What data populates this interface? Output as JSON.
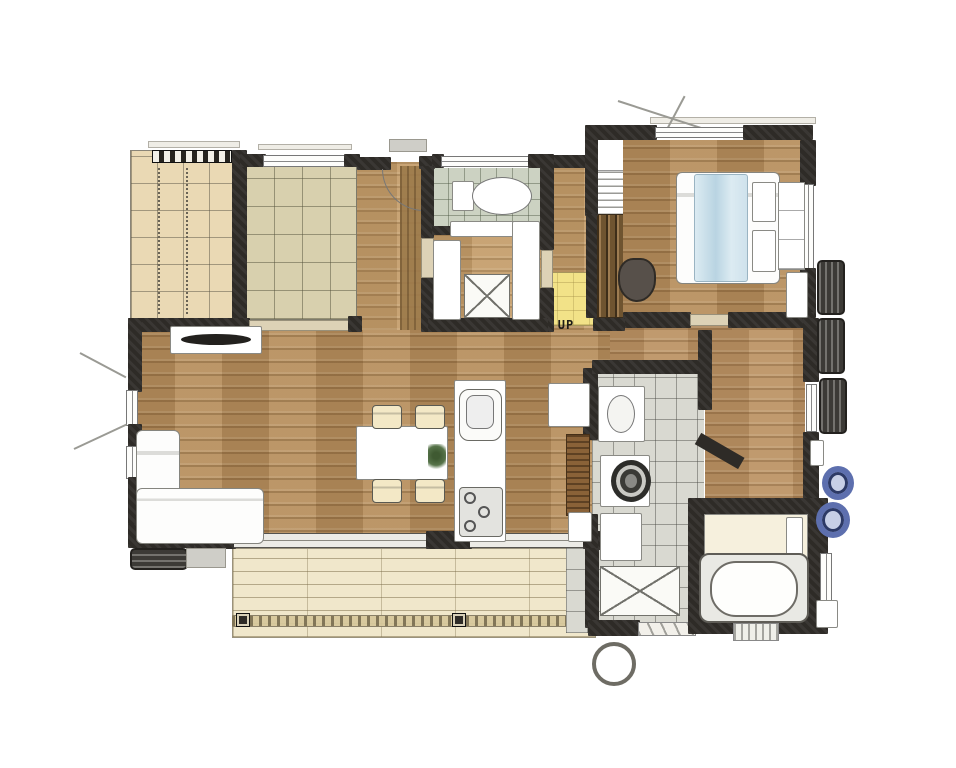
{
  "title": "hand-drawn house floor plan",
  "labels": {
    "stairs_up": "UP"
  },
  "palette": {
    "wall": "#2e2b27",
    "wood": "#b68f5e",
    "wood_light": "#c49e6c",
    "tatami": "#d8d0ae",
    "grid_beige": "#ead9b4",
    "tile_green": "#ccd2c2",
    "tile_gray": "#d9d9d1",
    "deck": "#f0e7cb",
    "landing": "#f2e288",
    "door_wood": "#8a6238",
    "accent_blue": "#5d6fae",
    "duvet_blue": "#cfe2ec"
  },
  "shapes": [
    {
      "n": "engawa-floor",
      "c": "grid-beige",
      "x": 130,
      "y": 150,
      "w": 106,
      "h": 170
    },
    {
      "n": "engawa-dot-strip",
      "c": "dot-strip",
      "x": 158,
      "y": 168,
      "w": 2,
      "h": 146
    },
    {
      "n": "engawa-dot-strip",
      "c": "dot-strip",
      "x": 186,
      "y": 168,
      "w": 2,
      "h": 146
    },
    {
      "n": "tatami-room-floor",
      "c": "tatami",
      "x": 245,
      "y": 162,
      "w": 112,
      "h": 158
    },
    {
      "n": "entrance-hall-floor",
      "c": "wood-light",
      "x": 357,
      "y": 162,
      "w": 70,
      "h": 170
    },
    {
      "n": "entrance-tataki-strip",
      "c": "wood-strip",
      "x": 400,
      "y": 166,
      "w": 26,
      "h": 164
    },
    {
      "n": "toilet-floor",
      "c": "tile-green",
      "x": 432,
      "y": 168,
      "w": 110,
      "h": 64
    },
    {
      "n": "storage-room-floor",
      "c": "wood-light",
      "x": 432,
      "y": 232,
      "w": 110,
      "h": 88
    },
    {
      "n": "hall-floor",
      "c": "wood-light",
      "x": 544,
      "y": 158,
      "w": 56,
      "h": 172
    },
    {
      "n": "stair-landing",
      "c": "landing",
      "x": 540,
      "y": 272,
      "w": 58,
      "h": 54
    },
    {
      "n": "stairwell",
      "c": "white-box",
      "x": 597,
      "y": 136,
      "w": 27,
      "h": 80
    },
    {
      "n": "stair-treads",
      "c": "treads",
      "x": 597,
      "y": 170,
      "w": 27,
      "h": 46
    },
    {
      "n": "stair-slats",
      "c": "slats",
      "x": 596,
      "y": 214,
      "w": 28,
      "h": 104
    },
    {
      "n": "bedroom-floor",
      "c": "wood",
      "x": 623,
      "y": 140,
      "w": 180,
      "h": 178
    },
    {
      "n": "corridor-floor",
      "c": "wood-mid",
      "x": 600,
      "y": 318,
      "w": 208,
      "h": 60
    },
    {
      "n": "corridor-floor",
      "c": "wood-mid",
      "x": 705,
      "y": 330,
      "w": 100,
      "h": 180
    },
    {
      "n": "ldk-floor",
      "c": "wood",
      "x": 128,
      "y": 330,
      "w": 482,
      "h": 215
    },
    {
      "n": "washroom-floor",
      "c": "tile-gray",
      "x": 592,
      "y": 372,
      "w": 112,
      "h": 258
    },
    {
      "n": "wood-deck",
      "c": "deck",
      "x": 232,
      "y": 548,
      "w": 364,
      "h": 90
    },
    {
      "n": "deck-runner",
      "c": "deck-runner",
      "x": 232,
      "y": 615,
      "w": 364,
      "h": 12
    },
    {
      "n": "deck-post",
      "c": "post-dark",
      "x": 236,
      "y": 613,
      "w": 14,
      "h": 14
    },
    {
      "n": "deck-post",
      "c": "post-dark",
      "x": 452,
      "y": 613,
      "w": 14,
      "h": 14
    },
    {
      "n": "outside-tile-patch",
      "c": "tile-gray",
      "x": 566,
      "y": 533,
      "w": 40,
      "h": 100
    },
    {
      "n": "eave-line",
      "c": "eave",
      "x": 148,
      "y": 141,
      "w": 92,
      "h": 7
    },
    {
      "n": "eave-line",
      "c": "eave",
      "x": 258,
      "y": 144,
      "w": 94,
      "h": 6
    },
    {
      "n": "eave-line",
      "c": "eave",
      "x": 650,
      "y": 117,
      "w": 166,
      "h": 7
    },
    {
      "n": "entrance-porch-step",
      "c": "porch",
      "x": 389,
      "y": 139,
      "w": 38,
      "h": 13
    },
    {
      "n": "canopy-line",
      "c": "line-diag",
      "x": 618,
      "y": 100,
      "w": 92,
      "h": 2,
      "r": 18
    },
    {
      "n": "canopy-line",
      "c": "line-diag",
      "x": 664,
      "y": 134,
      "w": 44,
      "h": 2,
      "r": -62
    },
    {
      "n": "closet-shelf-band",
      "c": "shelf-band",
      "x": 152,
      "y": 150,
      "w": 80,
      "h": 13
    },
    {
      "n": "wall",
      "c": "wall",
      "x": 232,
      "y": 150,
      "w": 15,
      "h": 170
    },
    {
      "n": "wall",
      "c": "wall",
      "x": 240,
      "y": 154,
      "w": 26,
      "h": 13
    },
    {
      "n": "tatami-window",
      "c": "window-h",
      "x": 263,
      "y": 155,
      "w": 84,
      "h": 12
    },
    {
      "n": "wall",
      "c": "wall",
      "x": 344,
      "y": 154,
      "w": 16,
      "h": 13
    },
    {
      "n": "wall",
      "c": "wall",
      "x": 357,
      "y": 157,
      "w": 34,
      "h": 13
    },
    {
      "n": "wall",
      "c": "wall",
      "x": 419,
      "y": 156,
      "w": 16,
      "h": 13
    },
    {
      "n": "wall",
      "c": "wall",
      "x": 432,
      "y": 154,
      "w": 12,
      "h": 14
    },
    {
      "n": "toilet-window",
      "c": "window-h",
      "x": 441,
      "y": 156,
      "w": 90,
      "h": 11
    },
    {
      "n": "wall",
      "c": "wall",
      "x": 528,
      "y": 154,
      "w": 16,
      "h": 14
    },
    {
      "n": "wall",
      "c": "wall",
      "x": 541,
      "y": 155,
      "w": 46,
      "h": 13
    },
    {
      "n": "entrance-door-arc",
      "c": "arc",
      "x": 382,
      "y": 169,
      "w": 42,
      "h": 42
    },
    {
      "n": "entrance-door-leaf",
      "c": "line-v",
      "x": 421,
      "y": 169,
      "w": 2,
      "h": 42
    },
    {
      "n": "wall",
      "c": "wall",
      "x": 421,
      "y": 166,
      "w": 13,
      "h": 72
    },
    {
      "n": "storage-door",
      "c": "door-light",
      "x": 421,
      "y": 238,
      "w": 13,
      "h": 40
    },
    {
      "n": "wall",
      "c": "wall",
      "x": 421,
      "y": 278,
      "w": 13,
      "h": 54
    },
    {
      "n": "wall",
      "c": "wall",
      "x": 432,
      "y": 226,
      "w": 80,
      "h": 9
    },
    {
      "n": "wall",
      "c": "wall",
      "x": 540,
      "y": 154,
      "w": 14,
      "h": 96
    },
    {
      "n": "toilet-door",
      "c": "door-light",
      "x": 541,
      "y": 250,
      "w": 12,
      "h": 38
    },
    {
      "n": "wall",
      "c": "wall",
      "x": 540,
      "y": 288,
      "w": 14,
      "h": 44
    },
    {
      "n": "wall",
      "c": "wall",
      "x": 585,
      "y": 128,
      "w": 13,
      "h": 88
    },
    {
      "n": "wall",
      "c": "wall",
      "x": 586,
      "y": 214,
      "w": 11,
      "h": 104
    },
    {
      "n": "wall",
      "c": "wall",
      "x": 585,
      "y": 125,
      "w": 72,
      "h": 15
    },
    {
      "n": "bedroom-window-north",
      "c": "window-h",
      "x": 655,
      "y": 127,
      "w": 90,
      "h": 11
    },
    {
      "n": "wall",
      "c": "wall",
      "x": 743,
      "y": 125,
      "w": 70,
      "h": 15
    },
    {
      "n": "wall",
      "c": "wall",
      "x": 800,
      "y": 140,
      "w": 16,
      "h": 46
    },
    {
      "n": "bedroom-window-east",
      "c": "window-v",
      "x": 803,
      "y": 184,
      "w": 11,
      "h": 86
    },
    {
      "n": "wall",
      "c": "wall",
      "x": 800,
      "y": 268,
      "w": 16,
      "h": 50
    },
    {
      "n": "wall",
      "c": "wall",
      "x": 623,
      "y": 312,
      "w": 68,
      "h": 16
    },
    {
      "n": "bedroom-door",
      "c": "door-light",
      "x": 690,
      "y": 314,
      "w": 40,
      "h": 12
    },
    {
      "n": "wall",
      "c": "wall",
      "x": 728,
      "y": 312,
      "w": 86,
      "h": 16
    },
    {
      "n": "wall",
      "c": "wall",
      "x": 128,
      "y": 318,
      "w": 122,
      "h": 14
    },
    {
      "n": "tatami-sliding-door",
      "c": "door-light",
      "x": 249,
      "y": 320,
      "w": 100,
      "h": 11
    },
    {
      "n": "wall",
      "c": "wall",
      "x": 348,
      "y": 316,
      "w": 14,
      "h": 16
    },
    {
      "n": "wall",
      "c": "wall",
      "x": 428,
      "y": 318,
      "w": 120,
      "h": 14
    },
    {
      "n": "wall",
      "c": "wall",
      "x": 593,
      "y": 318,
      "w": 32,
      "h": 13
    },
    {
      "n": "wall",
      "c": "wall",
      "x": 128,
      "y": 318,
      "w": 14,
      "h": 74
    },
    {
      "n": "living-window-west",
      "c": "window-v",
      "x": 126,
      "y": 390,
      "w": 12,
      "h": 36
    },
    {
      "n": "wall",
      "c": "wall",
      "x": 128,
      "y": 424,
      "w": 14,
      "h": 23
    },
    {
      "n": "living-window-west",
      "c": "window-v",
      "x": 126,
      "y": 446,
      "w": 12,
      "h": 33
    },
    {
      "n": "wall",
      "c": "wall",
      "x": 128,
      "y": 477,
      "w": 14,
      "h": 60
    },
    {
      "n": "window-vent-line",
      "c": "line-diag",
      "x": 80,
      "y": 352,
      "w": 52,
      "h": 2,
      "r": 28
    },
    {
      "n": "window-vent-line",
      "c": "line-diag",
      "x": 74,
      "y": 448,
      "w": 58,
      "h": 2,
      "r": -25
    },
    {
      "n": "wall",
      "c": "wall",
      "x": 128,
      "y": 524,
      "w": 70,
      "h": 24
    },
    {
      "n": "wall",
      "c": "wall",
      "x": 194,
      "y": 530,
      "w": 42,
      "h": 19
    },
    {
      "n": "deck-sliding-door",
      "c": "door-glass",
      "x": 234,
      "y": 533,
      "w": 194,
      "h": 15
    },
    {
      "n": "wall",
      "c": "wall",
      "x": 426,
      "y": 531,
      "w": 46,
      "h": 18
    },
    {
      "n": "deck-sliding-door",
      "c": "door-glass",
      "x": 470,
      "y": 533,
      "w": 120,
      "h": 15
    },
    {
      "n": "wall",
      "c": "wall",
      "x": 588,
      "y": 531,
      "w": 24,
      "h": 19
    },
    {
      "n": "wall",
      "c": "wall",
      "x": 583,
      "y": 368,
      "w": 15,
      "h": 72
    },
    {
      "n": "washroom-pocket-door",
      "c": "door-wood",
      "x": 566,
      "y": 434,
      "w": 24,
      "h": 82
    },
    {
      "n": "wall",
      "c": "wall",
      "x": 583,
      "y": 514,
      "w": 15,
      "h": 35
    },
    {
      "n": "wall",
      "c": "wall",
      "x": 585,
      "y": 548,
      "w": 14,
      "h": 80
    },
    {
      "n": "wall",
      "c": "wall",
      "x": 588,
      "y": 620,
      "w": 52,
      "h": 16
    },
    {
      "n": "shower-door-threshold",
      "c": "door-tri",
      "x": 638,
      "y": 622,
      "w": 58,
      "h": 14
    },
    {
      "n": "hose-ring",
      "c": "ring",
      "x": 592,
      "y": 642,
      "w": 44,
      "h": 44
    },
    {
      "n": "wall",
      "c": "wall",
      "x": 592,
      "y": 360,
      "w": 118,
      "h": 14
    },
    {
      "n": "wall",
      "c": "wall",
      "x": 698,
      "y": 330,
      "w": 14,
      "h": 80
    },
    {
      "n": "wall-angled",
      "c": "wall-diag",
      "x": 698,
      "y": 432,
      "w": 50,
      "h": 13,
      "r": 30
    },
    {
      "n": "wall",
      "c": "wall",
      "x": 803,
      "y": 318,
      "w": 16,
      "h": 64
    },
    {
      "n": "corridor-window-east",
      "c": "window-v",
      "x": 806,
      "y": 384,
      "w": 11,
      "h": 48
    },
    {
      "n": "wall",
      "c": "wall",
      "x": 803,
      "y": 432,
      "w": 16,
      "h": 76
    },
    {
      "n": "bathroom-walls",
      "c": "wall",
      "x": 688,
      "y": 498,
      "w": 140,
      "h": 136
    },
    {
      "n": "bathroom-washing-area",
      "c": "cream-box",
      "x": 704,
      "y": 514,
      "w": 104,
      "h": 44
    },
    {
      "n": "bathroom-door",
      "c": "white-box",
      "x": 786,
      "y": 517,
      "w": 17,
      "h": 40
    },
    {
      "n": "bathtub-surround",
      "c": "tub-surround",
      "x": 699,
      "y": 553,
      "w": 110,
      "h": 70
    },
    {
      "n": "bathtub",
      "c": "tub",
      "x": 710,
      "y": 561,
      "w": 88,
      "h": 56
    },
    {
      "n": "bath-mat",
      "c": "mat-stripe",
      "x": 733,
      "y": 623,
      "w": 46,
      "h": 18
    },
    {
      "n": "bath-window-east",
      "c": "window-v",
      "x": 820,
      "y": 553,
      "w": 12,
      "h": 48
    },
    {
      "n": "bath-vent-unit",
      "c": "white-box",
      "x": 816,
      "y": 600,
      "w": 22,
      "h": 28
    },
    {
      "n": "ac-outdoor-unit",
      "c": "ac-unit",
      "x": 817,
      "y": 260,
      "w": 28,
      "h": 55
    },
    {
      "n": "ac-outdoor-unit",
      "c": "ac-unit",
      "x": 817,
      "y": 318,
      "w": 28,
      "h": 56
    },
    {
      "n": "ac-outdoor-unit",
      "c": "ac-unit",
      "x": 819,
      "y": 378,
      "w": 28,
      "h": 56
    },
    {
      "n": "utility-box",
      "c": "white-box",
      "x": 810,
      "y": 440,
      "w": 14,
      "h": 26
    },
    {
      "n": "hose-reel",
      "c": "reel",
      "x": 822,
      "y": 466,
      "w": 32,
      "h": 34
    },
    {
      "n": "hose-reel",
      "c": "reel",
      "x": 816,
      "y": 502,
      "w": 34,
      "h": 36
    },
    {
      "n": "outdoor-unit",
      "c": "ac-unit-h",
      "x": 130,
      "y": 548,
      "w": 58,
      "h": 22
    },
    {
      "n": "garden-step",
      "c": "porch",
      "x": 186,
      "y": 548,
      "w": 40,
      "h": 20
    },
    {
      "n": "tv-board",
      "c": "white-box",
      "x": 170,
      "y": 326,
      "w": 92,
      "h": 28
    },
    {
      "n": "tv",
      "c": "tv",
      "x": 181,
      "y": 334,
      "w": 70,
      "h": 11
    },
    {
      "n": "sofa-chaise",
      "c": "soft",
      "x": 136,
      "y": 430,
      "w": 44,
      "h": 112
    },
    {
      "n": "sofa-body",
      "c": "soft",
      "x": 136,
      "y": 488,
      "w": 128,
      "h": 56
    },
    {
      "n": "dining-table",
      "c": "white-box",
      "x": 356,
      "y": 426,
      "w": 92,
      "h": 54
    },
    {
      "n": "dining-chair",
      "c": "chair-cream",
      "x": 372,
      "y": 405,
      "w": 30,
      "h": 24
    },
    {
      "n": "dining-chair",
      "c": "chair-cream",
      "x": 415,
      "y": 405,
      "w": 30,
      "h": 24
    },
    {
      "n": "dining-chair",
      "c": "chair-cream",
      "x": 372,
      "y": 479,
      "w": 30,
      "h": 24
    },
    {
      "n": "dining-chair",
      "c": "chair-cream",
      "x": 415,
      "y": 479,
      "w": 30,
      "h": 24
    },
    {
      "n": "table-plant",
      "c": "plant",
      "x": 428,
      "y": 444,
      "w": 18,
      "h": 26
    },
    {
      "n": "kitchen-counter",
      "c": "white-box",
      "x": 454,
      "y": 380,
      "w": 52,
      "h": 162
    },
    {
      "n": "kitchen-sink-unit",
      "c": "sink-unit",
      "x": 459,
      "y": 389,
      "w": 43,
      "h": 52
    },
    {
      "n": "kitchen-sink",
      "c": "sink-inner",
      "x": 466,
      "y": 395,
      "w": 28,
      "h": 34
    },
    {
      "n": "kitchen-stove",
      "c": "stove",
      "x": 459,
      "y": 487,
      "w": 44,
      "h": 50
    },
    {
      "n": "stove-burner",
      "c": "burner",
      "x": 464,
      "y": 492,
      "w": 12,
      "h": 12
    },
    {
      "n": "stove-burner",
      "c": "burner",
      "x": 478,
      "y": 506,
      "w": 12,
      "h": 12
    },
    {
      "n": "stove-burner",
      "c": "burner",
      "x": 464,
      "y": 520,
      "w": 12,
      "h": 12
    },
    {
      "n": "toilet-tank",
      "c": "white-box",
      "x": 452,
      "y": 181,
      "w": 22,
      "h": 30
    },
    {
      "n": "toilet-bowl",
      "c": "toilet-bowl",
      "x": 472,
      "y": 177,
      "w": 60,
      "h": 38
    },
    {
      "n": "storage-cabinet",
      "c": "white-box",
      "x": 450,
      "y": 221,
      "w": 66,
      "h": 16
    },
    {
      "n": "storage-cabinet",
      "c": "white-box",
      "x": 433,
      "y": 240,
      "w": 28,
      "h": 80
    },
    {
      "n": "storage-cabinet",
      "c": "white-box",
      "x": 512,
      "y": 221,
      "w": 28,
      "h": 99
    },
    {
      "n": "storage-hatch",
      "c": "x-box",
      "x": 464,
      "y": 274,
      "w": 46,
      "h": 44
    },
    {
      "n": "bed",
      "c": "soft",
      "x": 676,
      "y": 172,
      "w": 104,
      "h": 112
    },
    {
      "n": "bed-duvet",
      "c": "duvet",
      "x": 694,
      "y": 174,
      "w": 54,
      "h": 108
    },
    {
      "n": "bed-pillow",
      "c": "white-box",
      "x": 752,
      "y": 182,
      "w": 24,
      "h": 40
    },
    {
      "n": "bed-pillow",
      "c": "white-box",
      "x": 752,
      "y": 230,
      "w": 24,
      "h": 42
    },
    {
      "n": "bedroom-chair",
      "c": "chair-dark",
      "x": 618,
      "y": 258,
      "w": 38,
      "h": 44
    },
    {
      "n": "bedroom-closet",
      "c": "closet",
      "x": 778,
      "y": 182,
      "w": 27,
      "h": 88
    },
    {
      "n": "bedroom-closet",
      "c": "white-box",
      "x": 786,
      "y": 272,
      "w": 22,
      "h": 46
    },
    {
      "n": "washroom-vanity",
      "c": "white-box",
      "x": 598,
      "y": 386,
      "w": 47,
      "h": 56
    },
    {
      "n": "vanity-basin",
      "c": "basin",
      "x": 607,
      "y": 395,
      "w": 28,
      "h": 38
    },
    {
      "n": "washing-machine",
      "c": "white-box",
      "x": 600,
      "y": 455,
      "w": 50,
      "h": 52
    },
    {
      "n": "washer-drum",
      "c": "drum",
      "x": 611,
      "y": 460,
      "w": 40,
      "h": 42
    },
    {
      "n": "washroom-cabinet",
      "c": "white-box",
      "x": 600,
      "y": 513,
      "w": 42,
      "h": 48
    },
    {
      "n": "washroom-mat",
      "c": "x-box",
      "x": 600,
      "y": 566,
      "w": 80,
      "h": 50
    },
    {
      "n": "ldk-side-cabinet",
      "c": "white-box",
      "x": 548,
      "y": 383,
      "w": 42,
      "h": 44
    },
    {
      "n": "ldk-side-cabinet",
      "c": "white-box",
      "x": 568,
      "y": 512,
      "w": 24,
      "h": 30
    },
    {
      "n": "stairs-up-label",
      "c": "label-up",
      "x": 548,
      "y": 317,
      "w": 36,
      "h": 15,
      "bind": "labels.stairs_up"
    }
  ]
}
